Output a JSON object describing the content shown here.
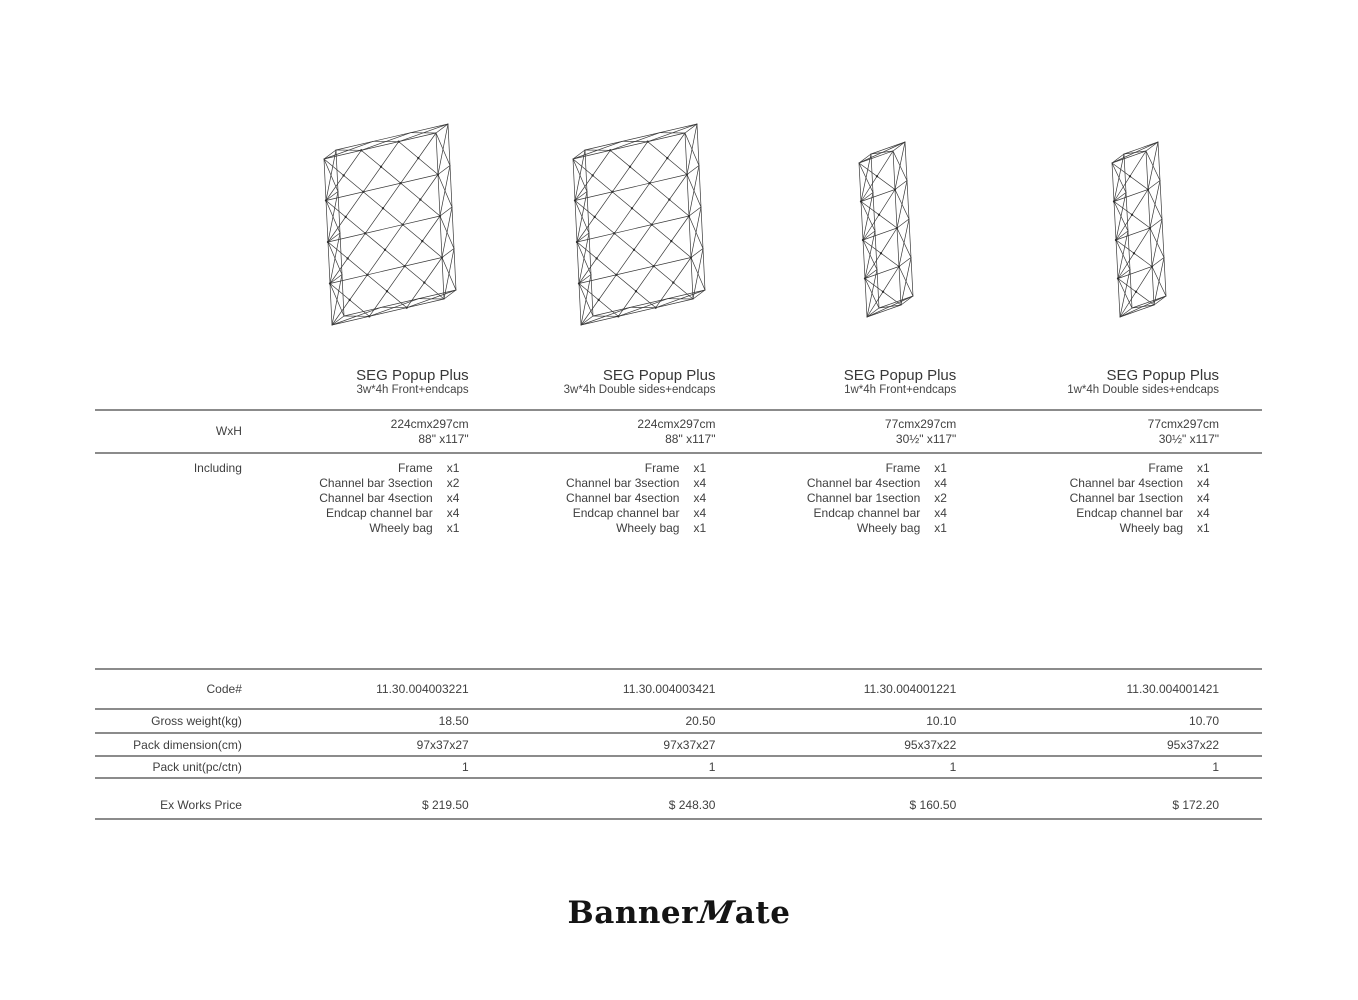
{
  "page": {
    "background": "#ffffff",
    "text_color": "#3f3f3f",
    "rule_color": "#8b8b8b"
  },
  "brand": {
    "logo_full": "BannerMate",
    "logo_prefix": "Banner",
    "logo_m": "M",
    "logo_suffix": "ate"
  },
  "row_labels": {
    "wxh": "WxH",
    "including": "Including",
    "code": "Code#",
    "gross_weight": "Gross weight(kg)",
    "pack_dimension": "Pack dimension(cm)",
    "pack_unit": "Pack unit(pc/ctn)",
    "price": "Ex Works Price"
  },
  "products": [
    {
      "title": "SEG Popup Plus",
      "subtitle": "3w*4h Front+endcaps",
      "size_cm": "224cmx297cm",
      "size_in": "88\" x117\"",
      "including": [
        {
          "item": "Frame",
          "qty": "x1"
        },
        {
          "item": "Channel bar 3section",
          "qty": "x2"
        },
        {
          "item": "Channel bar 4section",
          "qty": "x4"
        },
        {
          "item": "Endcap channel bar",
          "qty": "x4"
        },
        {
          "item": "Wheely bag",
          "qty": "x1"
        }
      ],
      "code": "11.30.004003221",
      "gross_weight": "18.50",
      "pack_dimension": "97x37x27",
      "pack_unit": "1",
      "price": "$ 219.50",
      "frame": {
        "type": "wide",
        "cols": 3,
        "rows": 4
      }
    },
    {
      "title": "SEG Popup Plus",
      "subtitle": "3w*4h Double sides+endcaps",
      "size_cm": "224cmx297cm",
      "size_in": "88\" x117\"",
      "including": [
        {
          "item": "Frame",
          "qty": "x1"
        },
        {
          "item": "Channel bar 3section",
          "qty": "x4"
        },
        {
          "item": "Channel bar 4section",
          "qty": "x4"
        },
        {
          "item": "Endcap channel bar",
          "qty": "x4"
        },
        {
          "item": "Wheely bag",
          "qty": "x1"
        }
      ],
      "code": "11.30.004003421",
      "gross_weight": "20.50",
      "pack_dimension": "97x37x27",
      "pack_unit": "1",
      "price": "$ 248.30",
      "frame": {
        "type": "wide",
        "cols": 3,
        "rows": 4
      }
    },
    {
      "title": "SEG Popup Plus",
      "subtitle": "1w*4h Front+endcaps",
      "size_cm": "77cmx297cm",
      "size_in": "30½\" x117\"",
      "including": [
        {
          "item": "Frame",
          "qty": "x1"
        },
        {
          "item": "Channel bar 4section",
          "qty": "x4"
        },
        {
          "item": "Channel bar 1section",
          "qty": "x2"
        },
        {
          "item": "Endcap channel bar",
          "qty": "x4"
        },
        {
          "item": "Wheely bag",
          "qty": "x1"
        }
      ],
      "code": "11.30.004001221",
      "gross_weight": "10.10",
      "pack_dimension": "95x37x22",
      "pack_unit": "1",
      "price": "$ 160.50",
      "frame": {
        "type": "tower",
        "cols": 1,
        "rows": 4
      }
    },
    {
      "title": "SEG Popup Plus",
      "subtitle": "1w*4h Double sides+endcaps",
      "size_cm": "77cmx297cm",
      "size_in": "30½\" x117\"",
      "including": [
        {
          "item": "Frame",
          "qty": "x1"
        },
        {
          "item": "Channel bar 4section",
          "qty": "x4"
        },
        {
          "item": "Channel bar 1section",
          "qty": "x4"
        },
        {
          "item": "Endcap channel bar",
          "qty": "x4"
        },
        {
          "item": "Wheely bag",
          "qty": "x1"
        }
      ],
      "code": "11.30.004001421",
      "gross_weight": "10.70",
      "pack_dimension": "95x37x22",
      "pack_unit": "1",
      "price": "$ 172.20",
      "frame": {
        "type": "tower",
        "cols": 1,
        "rows": 4
      }
    }
  ]
}
